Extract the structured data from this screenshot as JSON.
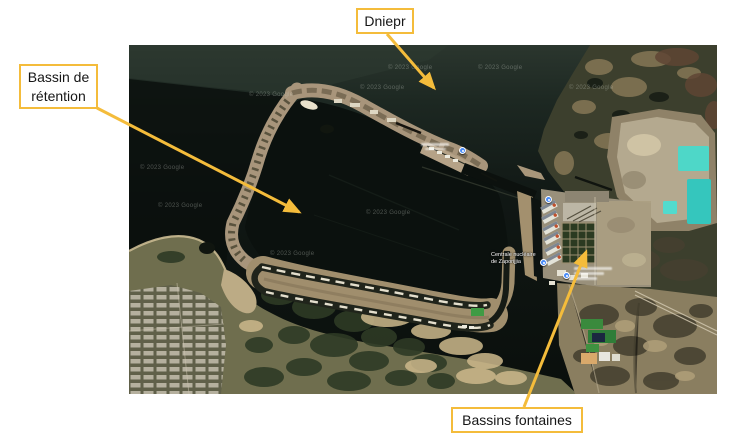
{
  "accent_color": "#F4BC3B",
  "slide": {
    "background": "#ffffff"
  },
  "callouts": {
    "dniepr": {
      "label": "Dniepr"
    },
    "bassin_retention": {
      "label": "Bassin de rétention"
    },
    "bassins_fontaines": {
      "label": "Bassins fontaines"
    }
  },
  "map": {
    "provider_watermark": "© 2023 Google",
    "plant_label": {
      "line1": "Centrale nucléaire",
      "line2": "de Zaporijjia"
    },
    "pin_color": "#4a8cf7",
    "colors": {
      "water_dark": "#0b100d",
      "dike_tan": "#a8957b",
      "ash_pond_turquoise": "#3fd0c4",
      "vegetation": "#2e3a25"
    }
  }
}
